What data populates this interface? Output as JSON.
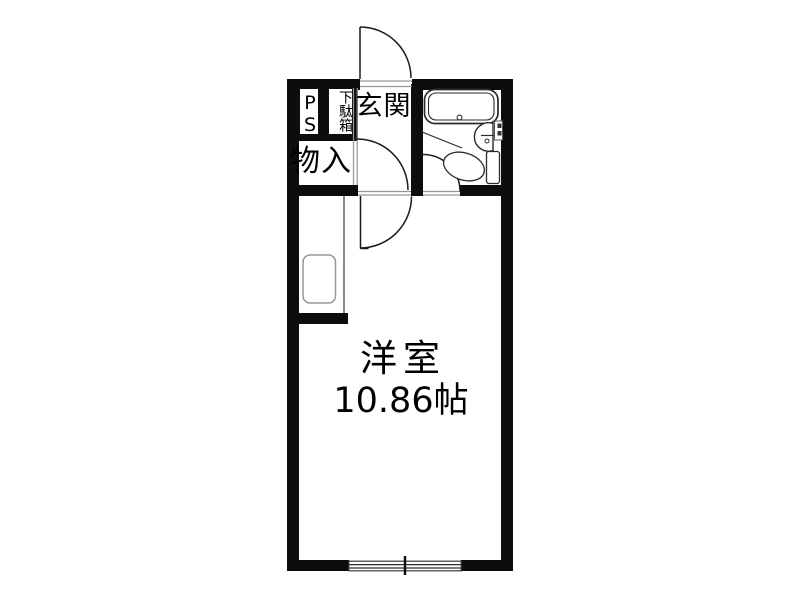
{
  "floorplan": {
    "labels": {
      "ps": "PS",
      "shoe_cabinet": "下駄箱",
      "entrance": "玄関",
      "storage": "物入"
    },
    "room": {
      "name": "洋室",
      "size": "10.86帖"
    },
    "colors": {
      "wall": "#0d0d0d",
      "line": "#1a1a1a",
      "thin": "#969696",
      "fixture": "#2a2a2a",
      "counter": "#979797",
      "bg": "#ffffff"
    }
  }
}
